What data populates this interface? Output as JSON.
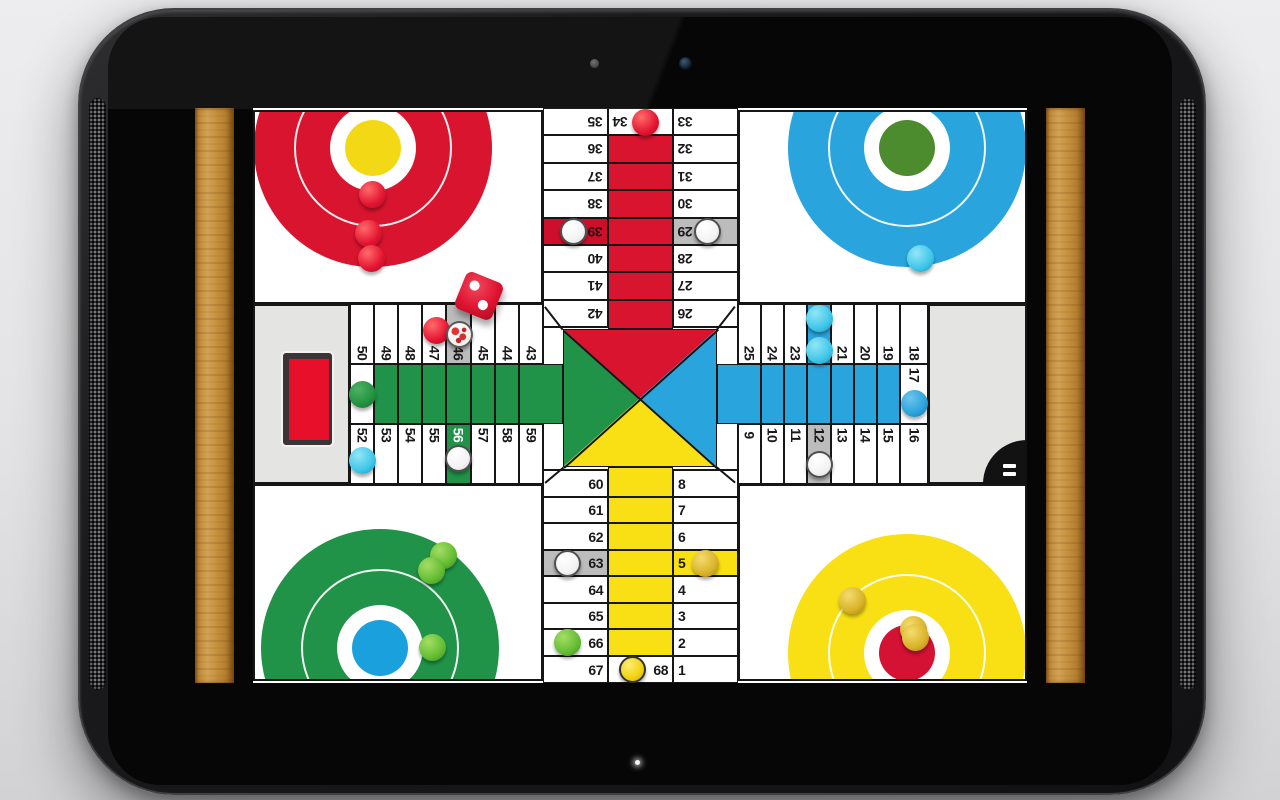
{
  "device": {
    "type": "tablet",
    "camera_icon": "front-camera",
    "sensor_icon": "light-sensor",
    "led_icon": "notification-led",
    "speaker_icon": "speaker-grille"
  },
  "board": {
    "game": "parcheesi",
    "colors": {
      "red": "#d8142f",
      "blue": "#2aa4dc",
      "green": "#209348",
      "yellow": "#f8e014",
      "gray": "#bcbcbc",
      "line": "#161616",
      "panel": "#e4e4e2",
      "cyan": "#3fc6e9",
      "gold": "#d9b328",
      "numDark": "#191919",
      "cellRed": "#ce0f2c",
      "cellRedText": "#2b0a10",
      "white": "#ffffff"
    },
    "radii": {
      "outer": 119,
      "ring": 79,
      "disc": 43,
      "inner": 28,
      "piece": 13.5
    },
    "bases": [
      {
        "name": "red-home",
        "panel": {
          "x": 58,
          "y": 2,
          "w": 290,
          "h": 194
        },
        "cx": 118,
        "cy": 36,
        "color": "red",
        "inner": "#f3d915",
        "pieces": [
          {
            "k": "red",
            "x": 117,
            "y": 82
          },
          {
            "k": "red",
            "x": 113,
            "y": 121
          },
          {
            "k": "red",
            "x": 116,
            "y": 146
          }
        ]
      },
      {
        "name": "blue-home",
        "panel": {
          "x": 543,
          "y": 2,
          "w": 289,
          "h": 194
        },
        "cx": 167,
        "cy": 36,
        "color": "blue",
        "inner": "#4c8c2e",
        "pieces": [
          {
            "k": "cyan",
            "x": 180,
            "y": 146
          }
        ]
      },
      {
        "name": "green-home",
        "panel": {
          "x": 58,
          "y": 376,
          "w": 290,
          "h": 197
        },
        "cx": 125,
        "cy": 162,
        "color": "green",
        "inner": "#1aa0dc",
        "pieces": [
          {
            "k": "green",
            "x": 188,
            "y": 69
          },
          {
            "k": "green",
            "x": 176,
            "y": 84
          },
          {
            "k": "green",
            "x": 177,
            "y": 161
          }
        ]
      },
      {
        "name": "yellow-home",
        "panel": {
          "x": 543,
          "y": 376,
          "w": 289,
          "h": 197
        },
        "cx": 167,
        "cy": 167,
        "color": "yellow",
        "inner": "#d41233",
        "pieces": [
          {
            "k": "gold",
            "x": 112,
            "y": 114
          },
          {
            "k": "gold",
            "x": 173,
            "y": 143
          },
          {
            "k": "gold",
            "x": 175,
            "y": 151
          }
        ]
      }
    ],
    "gray_panels": [
      {
        "name": "left-side-panel",
        "x": 58,
        "y": 196,
        "w": 97,
        "h": 180
      },
      {
        "name": "right-side-panel",
        "x": 733,
        "y": 196,
        "w": 99,
        "h": 180
      }
    ],
    "center": {
      "x": 348,
      "y": 219,
      "w": 195,
      "h": 143,
      "tri": {
        "x": 368,
        "y": 221,
        "w": 154,
        "h": 138
      }
    },
    "stretches": [
      {
        "c": "red",
        "x": 413,
        "y": 27,
        "w": 65,
        "h": 28
      },
      {
        "c": "red",
        "x": 413,
        "y": 55,
        "w": 65,
        "h": 27
      },
      {
        "c": "red",
        "x": 413,
        "y": 82,
        "w": 65,
        "h": 28
      },
      {
        "c": "red",
        "x": 413,
        "y": 110,
        "w": 65,
        "h": 27
      },
      {
        "c": "red",
        "x": 413,
        "y": 137,
        "w": 65,
        "h": 27
      },
      {
        "c": "red",
        "x": 413,
        "y": 164,
        "w": 65,
        "h": 28
      },
      {
        "c": "red",
        "x": 413,
        "y": 192,
        "w": 65,
        "h": 29
      },
      {
        "c": "yellow",
        "x": 413,
        "y": 359,
        "w": 65,
        "h": 30
      },
      {
        "c": "yellow",
        "x": 413,
        "y": 389,
        "w": 65,
        "h": 26
      },
      {
        "c": "yellow",
        "x": 413,
        "y": 415,
        "w": 65,
        "h": 27
      },
      {
        "c": "yellow",
        "x": 413,
        "y": 442,
        "w": 65,
        "h": 26
      },
      {
        "c": "yellow",
        "x": 413,
        "y": 468,
        "w": 65,
        "h": 27
      },
      {
        "c": "yellow",
        "x": 413,
        "y": 495,
        "w": 65,
        "h": 26
      },
      {
        "c": "yellow",
        "x": 413,
        "y": 521,
        "w": 65,
        "h": 27
      },
      {
        "c": "green",
        "x": 179,
        "y": 256,
        "w": 24,
        "h": 60
      },
      {
        "c": "green",
        "x": 203,
        "y": 256,
        "w": 24,
        "h": 60
      },
      {
        "c": "green",
        "x": 227,
        "y": 256,
        "w": 24,
        "h": 60
      },
      {
        "c": "green",
        "x": 251,
        "y": 256,
        "w": 25,
        "h": 60
      },
      {
        "c": "green",
        "x": 276,
        "y": 256,
        "w": 24,
        "h": 60
      },
      {
        "c": "green",
        "x": 300,
        "y": 256,
        "w": 24,
        "h": 60
      },
      {
        "c": "green",
        "x": 324,
        "y": 256,
        "w": 44,
        "h": 60
      },
      {
        "c": "blue",
        "x": 522,
        "y": 256,
        "w": 44,
        "h": 60
      },
      {
        "c": "blue",
        "x": 566,
        "y": 256,
        "w": 23,
        "h": 60
      },
      {
        "c": "blue",
        "x": 589,
        "y": 256,
        "w": 23,
        "h": 60
      },
      {
        "c": "blue",
        "x": 612,
        "y": 256,
        "w": 24,
        "h": 60
      },
      {
        "c": "blue",
        "x": 636,
        "y": 256,
        "w": 23,
        "h": 60
      },
      {
        "c": "blue",
        "x": 659,
        "y": 256,
        "w": 23,
        "h": 60
      },
      {
        "c": "blue",
        "x": 682,
        "y": 256,
        "w": 23,
        "h": 60
      }
    ],
    "cells": [
      {
        "n": "35",
        "x": 348,
        "y": 0,
        "w": 65,
        "h": 27,
        "r": 180,
        "ax": "r",
        "ay": "c"
      },
      {
        "n": "36",
        "x": 348,
        "y": 27,
        "w": 65,
        "h": 28,
        "r": 180,
        "ax": "r",
        "ay": "c"
      },
      {
        "n": "37",
        "x": 348,
        "y": 55,
        "w": 65,
        "h": 27,
        "r": 180,
        "ax": "r",
        "ay": "c"
      },
      {
        "n": "38",
        "x": 348,
        "y": 82,
        "w": 65,
        "h": 28,
        "r": 180,
        "ax": "r",
        "ay": "c"
      },
      {
        "n": "39",
        "x": 348,
        "y": 110,
        "w": 65,
        "h": 27,
        "r": 180,
        "ax": "r",
        "ay": "c",
        "bg": "cellRed",
        "fg": "#2b0a10"
      },
      {
        "n": "40",
        "x": 348,
        "y": 137,
        "w": 65,
        "h": 27,
        "r": 180,
        "ax": "r",
        "ay": "c"
      },
      {
        "n": "41",
        "x": 348,
        "y": 164,
        "w": 65,
        "h": 28,
        "r": 180,
        "ax": "r",
        "ay": "c"
      },
      {
        "n": "42",
        "x": 348,
        "y": 192,
        "w": 65,
        "h": 27,
        "r": 180,
        "ax": "r",
        "ay": "c"
      },
      {
        "n": "34",
        "x": 413,
        "y": 0,
        "w": 65,
        "h": 27,
        "r": 180,
        "ax": "l",
        "ay": "c"
      },
      {
        "n": "33",
        "x": 478,
        "y": 0,
        "w": 65,
        "h": 27,
        "r": 180,
        "ax": "l",
        "ay": "c"
      },
      {
        "n": "32",
        "x": 478,
        "y": 27,
        "w": 65,
        "h": 28,
        "r": 180,
        "ax": "l",
        "ay": "c"
      },
      {
        "n": "31",
        "x": 478,
        "y": 55,
        "w": 65,
        "h": 27,
        "r": 180,
        "ax": "l",
        "ay": "c"
      },
      {
        "n": "30",
        "x": 478,
        "y": 82,
        "w": 65,
        "h": 28,
        "r": 180,
        "ax": "l",
        "ay": "c"
      },
      {
        "n": "29",
        "x": 478,
        "y": 110,
        "w": 65,
        "h": 27,
        "r": 180,
        "ax": "l",
        "ay": "c",
        "bg": "gray"
      },
      {
        "n": "28",
        "x": 478,
        "y": 137,
        "w": 65,
        "h": 27,
        "r": 180,
        "ax": "l",
        "ay": "c"
      },
      {
        "n": "27",
        "x": 478,
        "y": 164,
        "w": 65,
        "h": 28,
        "r": 180,
        "ax": "l",
        "ay": "c"
      },
      {
        "n": "26",
        "x": 478,
        "y": 192,
        "w": 65,
        "h": 27,
        "r": 180,
        "ax": "l",
        "ay": "c"
      },
      {
        "n": "60",
        "x": 348,
        "y": 362,
        "w": 65,
        "h": 27,
        "r": 0,
        "ax": "r",
        "ay": "c"
      },
      {
        "n": "61",
        "x": 348,
        "y": 389,
        "w": 65,
        "h": 26,
        "r": 0,
        "ax": "r",
        "ay": "c"
      },
      {
        "n": "62",
        "x": 348,
        "y": 415,
        "w": 65,
        "h": 27,
        "r": 0,
        "ax": "r",
        "ay": "c"
      },
      {
        "n": "63",
        "x": 348,
        "y": 442,
        "w": 65,
        "h": 26,
        "r": 0,
        "ax": "r",
        "ay": "c",
        "bg": "gray"
      },
      {
        "n": "64",
        "x": 348,
        "y": 468,
        "w": 65,
        "h": 27,
        "r": 0,
        "ax": "r",
        "ay": "c"
      },
      {
        "n": "65",
        "x": 348,
        "y": 495,
        "w": 65,
        "h": 26,
        "r": 0,
        "ax": "r",
        "ay": "c"
      },
      {
        "n": "66",
        "x": 348,
        "y": 521,
        "w": 65,
        "h": 27,
        "r": 0,
        "ax": "r",
        "ay": "c"
      },
      {
        "n": "67",
        "x": 348,
        "y": 548,
        "w": 65,
        "h": 27,
        "r": 0,
        "ax": "r",
        "ay": "c"
      },
      {
        "n": "68",
        "x": 413,
        "y": 548,
        "w": 65,
        "h": 27,
        "r": 0,
        "ax": "r",
        "ay": "c"
      },
      {
        "n": "8",
        "x": 478,
        "y": 362,
        "w": 65,
        "h": 27,
        "r": 0,
        "ax": "l",
        "ay": "c"
      },
      {
        "n": "7",
        "x": 478,
        "y": 389,
        "w": 65,
        "h": 26,
        "r": 0,
        "ax": "l",
        "ay": "c"
      },
      {
        "n": "6",
        "x": 478,
        "y": 415,
        "w": 65,
        "h": 27,
        "r": 0,
        "ax": "l",
        "ay": "c"
      },
      {
        "n": "5",
        "x": 478,
        "y": 442,
        "w": 65,
        "h": 26,
        "r": 0,
        "ax": "l",
        "ay": "c",
        "bg": "yellow"
      },
      {
        "n": "4",
        "x": 478,
        "y": 468,
        "w": 65,
        "h": 27,
        "r": 0,
        "ax": "l",
        "ay": "c"
      },
      {
        "n": "3",
        "x": 478,
        "y": 495,
        "w": 65,
        "h": 26,
        "r": 0,
        "ax": "l",
        "ay": "c"
      },
      {
        "n": "2",
        "x": 478,
        "y": 521,
        "w": 65,
        "h": 27,
        "r": 0,
        "ax": "l",
        "ay": "c"
      },
      {
        "n": "1",
        "x": 478,
        "y": 548,
        "w": 65,
        "h": 27,
        "r": 0,
        "ax": "l",
        "ay": "c"
      },
      {
        "n": "50",
        "x": 155,
        "y": 196,
        "w": 24,
        "h": 60,
        "r": 90,
        "ax": "c",
        "ay": "b"
      },
      {
        "n": "49",
        "x": 179,
        "y": 196,
        "w": 24,
        "h": 60,
        "r": 90,
        "ax": "c",
        "ay": "b"
      },
      {
        "n": "48",
        "x": 203,
        "y": 196,
        "w": 24,
        "h": 60,
        "r": 90,
        "ax": "c",
        "ay": "b"
      },
      {
        "n": "47",
        "x": 227,
        "y": 196,
        "w": 24,
        "h": 60,
        "r": 90,
        "ax": "c",
        "ay": "b"
      },
      {
        "n": "46",
        "x": 251,
        "y": 196,
        "w": 25,
        "h": 60,
        "r": 90,
        "ax": "c",
        "ay": "b",
        "bg": "gray"
      },
      {
        "n": "45",
        "x": 276,
        "y": 196,
        "w": 24,
        "h": 60,
        "r": 90,
        "ax": "c",
        "ay": "b"
      },
      {
        "n": "44",
        "x": 300,
        "y": 196,
        "w": 24,
        "h": 60,
        "r": 90,
        "ax": "c",
        "ay": "b"
      },
      {
        "n": "43",
        "x": 324,
        "y": 196,
        "w": 24,
        "h": 60,
        "r": 90,
        "ax": "c",
        "ay": "b"
      },
      {
        "n": "51",
        "x": 155,
        "y": 256,
        "w": 24,
        "h": 60,
        "r": 90,
        "ax": "c",
        "ay": "c"
      },
      {
        "n": "52",
        "x": 155,
        "y": 316,
        "w": 24,
        "h": 60,
        "r": 90,
        "ax": "c",
        "ay": "t"
      },
      {
        "n": "53",
        "x": 179,
        "y": 316,
        "w": 24,
        "h": 60,
        "r": 90,
        "ax": "c",
        "ay": "t"
      },
      {
        "n": "54",
        "x": 203,
        "y": 316,
        "w": 24,
        "h": 60,
        "r": 90,
        "ax": "c",
        "ay": "t"
      },
      {
        "n": "55",
        "x": 227,
        "y": 316,
        "w": 24,
        "h": 60,
        "r": 90,
        "ax": "c",
        "ay": "t"
      },
      {
        "n": "56",
        "x": 251,
        "y": 316,
        "w": 25,
        "h": 60,
        "r": 90,
        "ax": "c",
        "ay": "t",
        "bg": "green",
        "fg": "#ffffff"
      },
      {
        "n": "57",
        "x": 276,
        "y": 316,
        "w": 24,
        "h": 60,
        "r": 90,
        "ax": "c",
        "ay": "t"
      },
      {
        "n": "58",
        "x": 300,
        "y": 316,
        "w": 24,
        "h": 60,
        "r": 90,
        "ax": "c",
        "ay": "t"
      },
      {
        "n": "59",
        "x": 324,
        "y": 316,
        "w": 24,
        "h": 60,
        "r": 90,
        "ax": "c",
        "ay": "t"
      },
      {
        "n": "25",
        "x": 543,
        "y": 196,
        "w": 23,
        "h": 60,
        "r": 90,
        "ax": "c",
        "ay": "b"
      },
      {
        "n": "24",
        "x": 566,
        "y": 196,
        "w": 23,
        "h": 60,
        "r": 90,
        "ax": "c",
        "ay": "b"
      },
      {
        "n": "23",
        "x": 589,
        "y": 196,
        "w": 23,
        "h": 60,
        "r": 90,
        "ax": "c",
        "ay": "b"
      },
      {
        "n": "22",
        "x": 612,
        "y": 196,
        "w": 24,
        "h": 60,
        "r": 90,
        "ax": "c",
        "ay": "b",
        "bg": "blue",
        "fg": "#ffffff"
      },
      {
        "n": "21",
        "x": 636,
        "y": 196,
        "w": 23,
        "h": 60,
        "r": 90,
        "ax": "c",
        "ay": "b"
      },
      {
        "n": "20",
        "x": 659,
        "y": 196,
        "w": 23,
        "h": 60,
        "r": 90,
        "ax": "c",
        "ay": "b"
      },
      {
        "n": "19",
        "x": 682,
        "y": 196,
        "w": 23,
        "h": 60,
        "r": 90,
        "ax": "c",
        "ay": "b"
      },
      {
        "n": "18",
        "x": 705,
        "y": 196,
        "w": 28,
        "h": 60,
        "r": 90,
        "ax": "c",
        "ay": "b"
      },
      {
        "n": "17",
        "x": 705,
        "y": 256,
        "w": 28,
        "h": 60,
        "r": 90,
        "ax": "c",
        "ay": "t"
      },
      {
        "n": "9",
        "x": 543,
        "y": 316,
        "w": 23,
        "h": 60,
        "r": 90,
        "ax": "c",
        "ay": "t"
      },
      {
        "n": "10",
        "x": 566,
        "y": 316,
        "w": 23,
        "h": 60,
        "r": 90,
        "ax": "c",
        "ay": "t"
      },
      {
        "n": "11",
        "x": 589,
        "y": 316,
        "w": 23,
        "h": 60,
        "r": 90,
        "ax": "c",
        "ay": "t"
      },
      {
        "n": "12",
        "x": 612,
        "y": 316,
        "w": 24,
        "h": 60,
        "r": 90,
        "ax": "c",
        "ay": "t",
        "bg": "gray"
      },
      {
        "n": "13",
        "x": 636,
        "y": 316,
        "w": 23,
        "h": 60,
        "r": 90,
        "ax": "c",
        "ay": "t"
      },
      {
        "n": "14",
        "x": 659,
        "y": 316,
        "w": 23,
        "h": 60,
        "r": 90,
        "ax": "c",
        "ay": "t"
      },
      {
        "n": "15",
        "x": 682,
        "y": 316,
        "w": 23,
        "h": 60,
        "r": 90,
        "ax": "c",
        "ay": "t"
      },
      {
        "n": "16",
        "x": 705,
        "y": 316,
        "w": 28,
        "h": 60,
        "r": 90,
        "ax": "c",
        "ay": "t"
      }
    ],
    "corner_lines": [
      {
        "x": 350,
        "y": 198,
        "len": 29,
        "ang": 52
      },
      {
        "x": 540,
        "y": 198,
        "len": 29,
        "ang": 128
      },
      {
        "x": 350,
        "y": 374,
        "len": 24,
        "ang": -40
      },
      {
        "x": 540,
        "y": 374,
        "len": 24,
        "ang": -140
      }
    ],
    "track_pieces": [
      {
        "k": "red",
        "x": 450,
        "y": 14,
        "cell": "34"
      },
      {
        "k": "white",
        "x": 378,
        "y": 123,
        "cell": "39"
      },
      {
        "k": "white",
        "x": 512,
        "y": 123,
        "cell": "29"
      },
      {
        "k": "cyan",
        "x": 624,
        "y": 210,
        "cell": "22"
      },
      {
        "k": "cyan",
        "x": 624,
        "y": 242,
        "cell": "22"
      },
      {
        "k": "blue",
        "x": 719,
        "y": 295,
        "cell": "17"
      },
      {
        "k": "white",
        "x": 624,
        "y": 356,
        "cell": "12"
      },
      {
        "k": "red",
        "x": 241,
        "y": 222,
        "cell": "47"
      },
      {
        "k": "speck",
        "x": 264,
        "y": 226,
        "cell": "46"
      },
      {
        "k": "dgreen",
        "x": 167,
        "y": 286,
        "cell": "51"
      },
      {
        "k": "cyan",
        "x": 167,
        "y": 352,
        "cell": "52"
      },
      {
        "k": "white",
        "x": 263,
        "y": 350,
        "cell": "56"
      },
      {
        "k": "white",
        "x": 372,
        "y": 455,
        "cell": "63"
      },
      {
        "k": "gold",
        "x": 510,
        "y": 455,
        "cell": "5"
      },
      {
        "k": "green",
        "x": 372,
        "y": 534,
        "cell": "66"
      },
      {
        "k": "yellow",
        "x": 437,
        "y": 561,
        "cell": "68"
      }
    ],
    "die": {
      "x": 284,
      "y": 188,
      "size": 40,
      "rot": 22,
      "value": 2,
      "color": "#e01430"
    },
    "tray": {
      "x": 88,
      "y": 245,
      "w": 40,
      "h": 81,
      "color": "#e80f2b"
    },
    "menu": {
      "x": 788,
      "y": 332,
      "size": 44,
      "bar_count": 2
    }
  }
}
